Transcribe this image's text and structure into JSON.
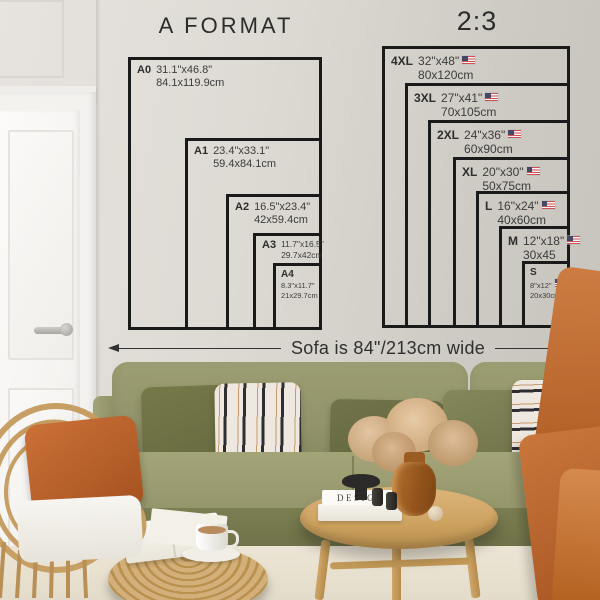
{
  "wall_charts": {
    "a_format": {
      "title": "A FORMAT",
      "sizes": [
        {
          "label": "A0",
          "inches": "31.1\"x46.8\"",
          "cm": "84.1x119.9cm"
        },
        {
          "label": "A1",
          "inches": "23.4\"x33.1\"",
          "cm": "59.4x84.1cm"
        },
        {
          "label": "A2",
          "inches": "16.5\"x23.4\"",
          "cm": "42x59.4cm"
        },
        {
          "label": "A3",
          "inches": "11.7\"x16.5\"",
          "cm": "29.7x42cm"
        },
        {
          "label": "A4",
          "inches": "8.3\"x11.7\"",
          "cm": "21x29.7cm"
        }
      ]
    },
    "ratio": {
      "title": "2:3",
      "sizes": [
        {
          "label": "4XL",
          "inches": "32\"x48\"",
          "cm": "80x120cm",
          "flag": "us-flag"
        },
        {
          "label": "3XL",
          "inches": "27\"x41\"",
          "cm": "70x105cm",
          "flag": "us-flag"
        },
        {
          "label": "2XL",
          "inches": "24\"x36\"",
          "cm": "60x90cm",
          "flag": "us-flag"
        },
        {
          "label": "XL",
          "inches": "20\"x30\"",
          "cm": "50x75cm",
          "flag": "us-flag"
        },
        {
          "label": "L",
          "inches": "16\"x24\"",
          "cm": "40x60cm",
          "flag": "us-flag"
        },
        {
          "label": "M",
          "inches": "12\"x18\"",
          "cm": "30x45",
          "flag": "us-flag"
        },
        {
          "label": "S",
          "inches": "8\"x12\"",
          "cm": "20x30cm",
          "flag": "us-flag"
        }
      ]
    },
    "sofa_note": "Sofa is 84\"/213cm wide"
  },
  "decor": {
    "book_title": "DESIGN"
  }
}
